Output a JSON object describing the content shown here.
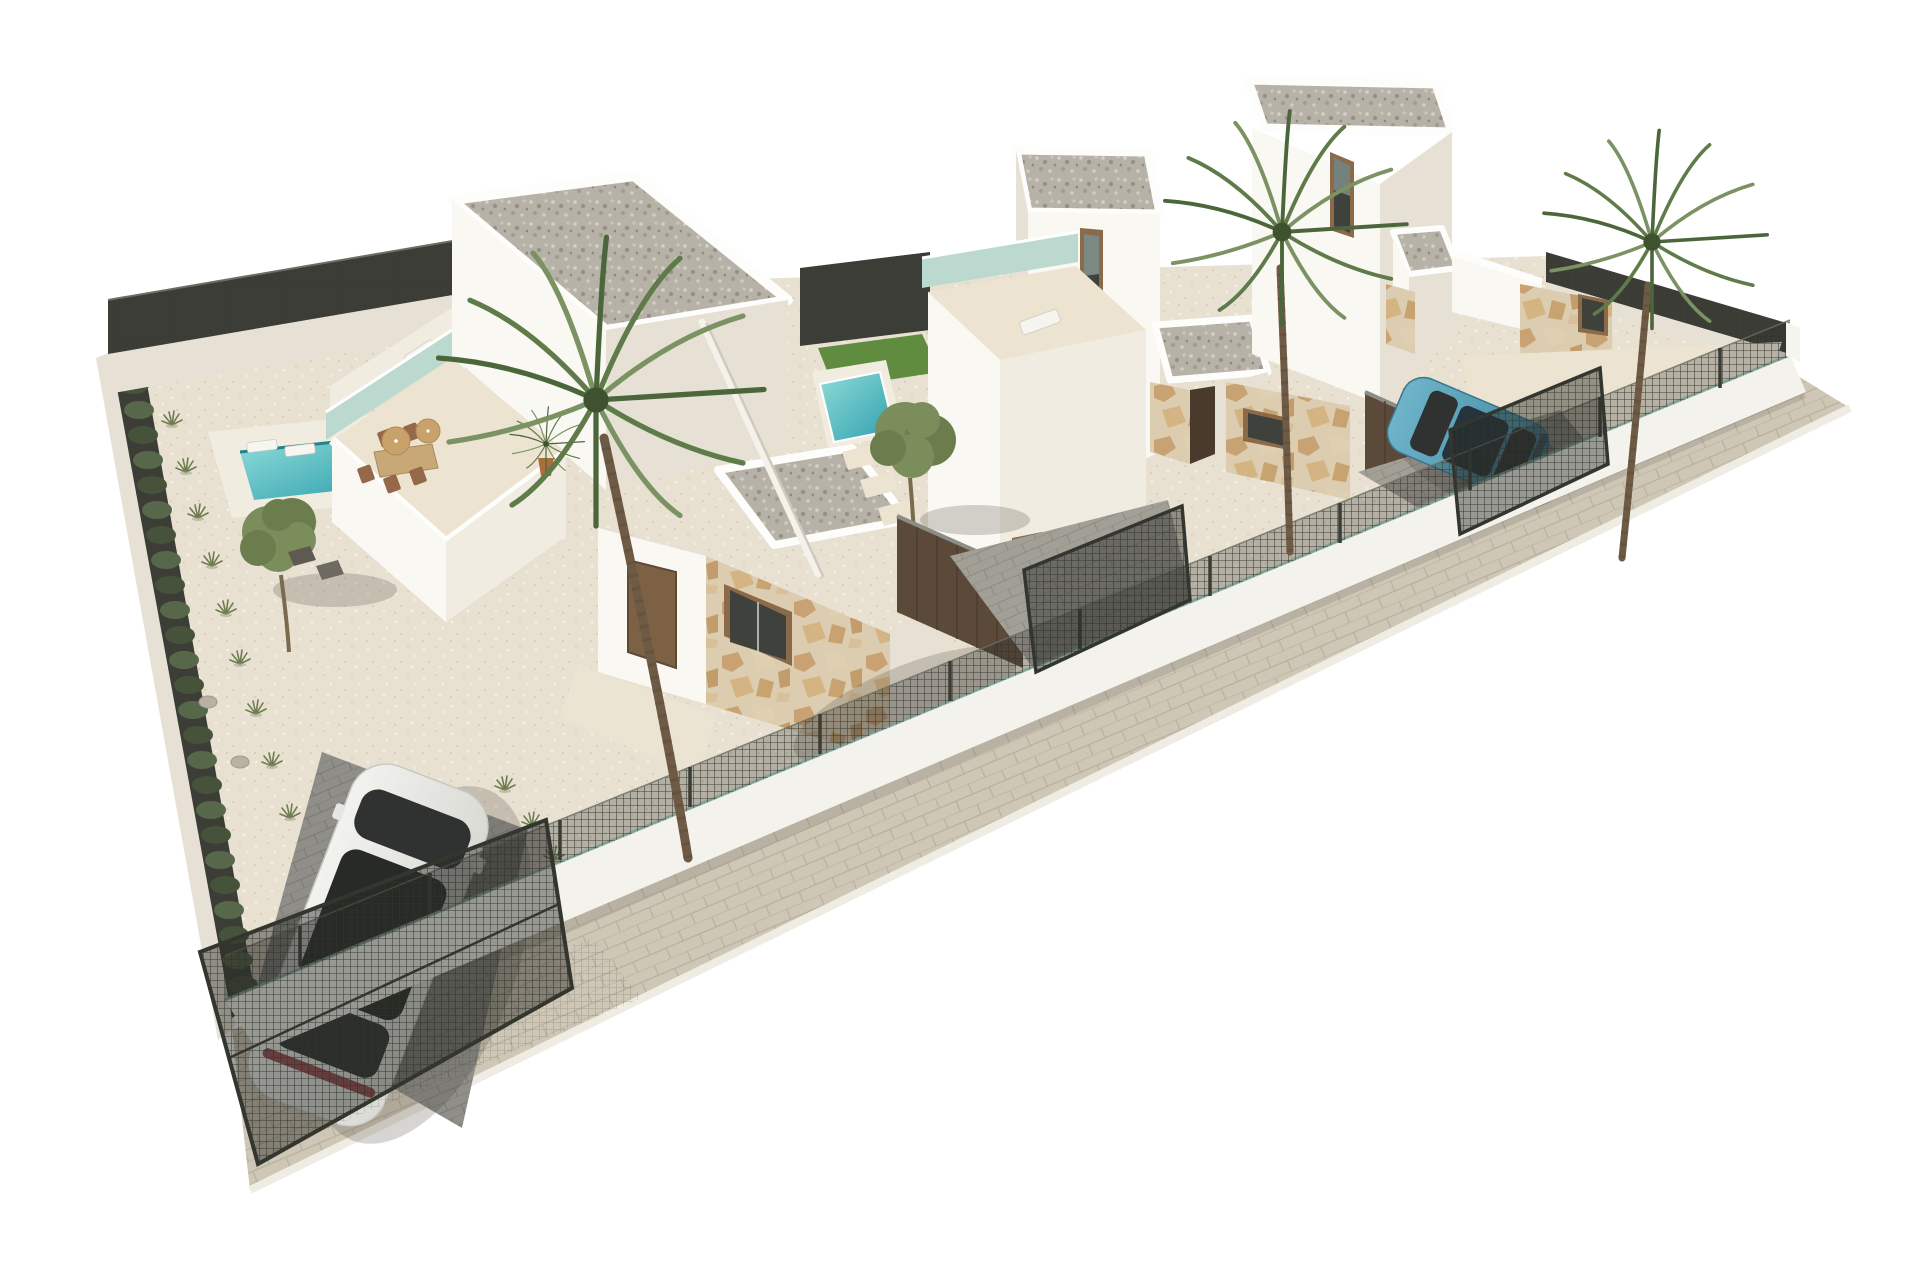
{
  "scene": {
    "type": "architectural-3d-render",
    "description": "Aerial 3D render of a row of three new-build white modern villas on a fenced corner plot, with gravel gardens, private pools, roof terraces, palm trees, olive trees and two parked cars",
    "background": "#ffffff"
  },
  "objects": {
    "villas": 3,
    "swimming_pools": 2,
    "roof_terraces": 2,
    "palm_trees": 3,
    "olive_trees": 2,
    "cars": 2,
    "car_colors": [
      "white",
      "teal-blue"
    ],
    "perimeter": "low white wall with dark metal mesh fence and sliding gates",
    "ground": "cream gravel with paver driveways and sidewalk"
  },
  "colors": {
    "bg": "#ffffff",
    "sidewalk": "#cfc7b6",
    "sidewalk_line": "#b9afa0",
    "curb": "#efece4",
    "gravel": "#e8e1d2",
    "wall_lit": "#faf8f2",
    "wall_mid": "#f0ece1",
    "wall_shade": "#e7e1d5",
    "parapet": "#fdfdfb",
    "roof_gravel": "#b7b2a8",
    "stone": "#dccdb0",
    "glass_teal": "#bcd9cf",
    "pool_light": "#8fdcd8",
    "pool_deep": "#2e9fae",
    "lawn": "#5f8c3f",
    "hedge": "#46523a",
    "hedge_light": "#57684a",
    "fence_dark": "#3b3d36",
    "fence_hilite": "#6b6e63",
    "wood_wall": "#5b4a3a",
    "wood_edge": "#8d8d86",
    "door_brown": "#7d6145",
    "door_dark": "#4a3a2c",
    "frame_brown": "#8a6a48",
    "glass_dark": "#3f423c",
    "travertine": "#ece4d1",
    "paver": "#a29f97",
    "paver_dark": "#8f8e88",
    "trunk": "#6f5b45",
    "palm_dark": "#4c663c",
    "palm_mid": "#5f7b4a",
    "palm_light": "#7b9363",
    "car_white": "#f2f2ef",
    "car_white_dark": "#d9dad4",
    "car_glass": "#2f3230",
    "taillight": "#8c2f36",
    "car_blue": "#6fb4c9",
    "car_blue_dark": "#3f87a1",
    "shadow": "rgba(70,65,55,0.22)",
    "olive": "#7c8d5c",
    "olive_dark": "#6b7d4c",
    "table_tan": "#c9a878",
    "parasol_tan": "#c8a26a",
    "plant_green": "#6d7c4e",
    "rock_gray": "#b9b2a4",
    "deck_white": "#f1ece0"
  }
}
